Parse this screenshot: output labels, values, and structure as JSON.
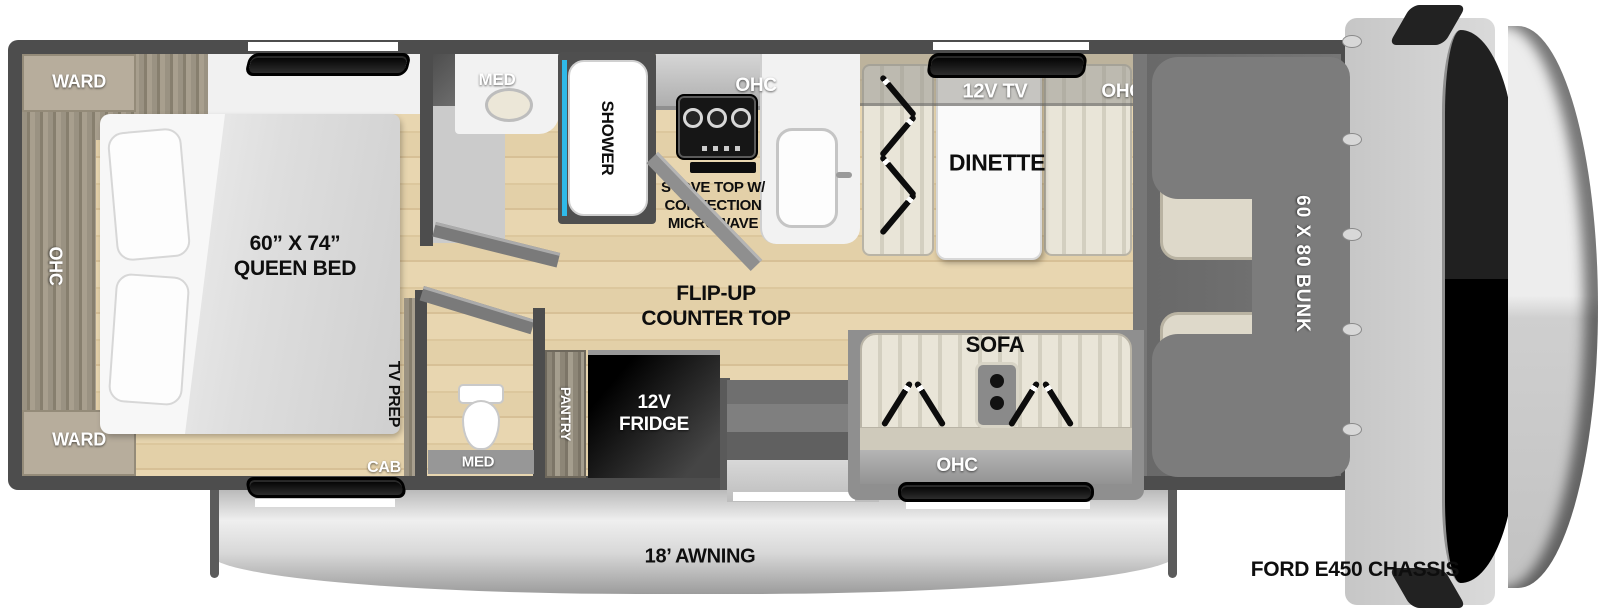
{
  "coach": {
    "bedroom": {
      "ward_top": "WARD",
      "ward_bottom": "WARD",
      "ohc": "OHC",
      "bed_size": "60” X 74”",
      "bed_name": "QUEEN BED",
      "tv_prep": "TV PREP",
      "cab": "CAB"
    },
    "bathroom": {
      "med": "MED",
      "shower": "SHOWER"
    },
    "kitchen": {
      "ohc": "OHC",
      "stove_line1": "STOVE TOP W/",
      "stove_line2": "CONVECTION",
      "stove_line3": "MICROWAVE",
      "counter_line1": "FLIP-UP",
      "counter_line2": "COUNTER TOP",
      "fridge_line1": "12V",
      "fridge_line2": "FRIDGE",
      "pantry": "PANTRY"
    },
    "rear_bath": {
      "med": "MED"
    },
    "dinette": {
      "label": "DINETTE",
      "tv": "12V TV",
      "ohc": "OHC"
    },
    "sofa": {
      "label": "SOFA",
      "ohc": "OHC"
    },
    "bunk": "60 X 80 BUNK"
  },
  "exterior": {
    "awning": "18’ AWNING",
    "chassis": "FORD E450 CHASSIS"
  }
}
